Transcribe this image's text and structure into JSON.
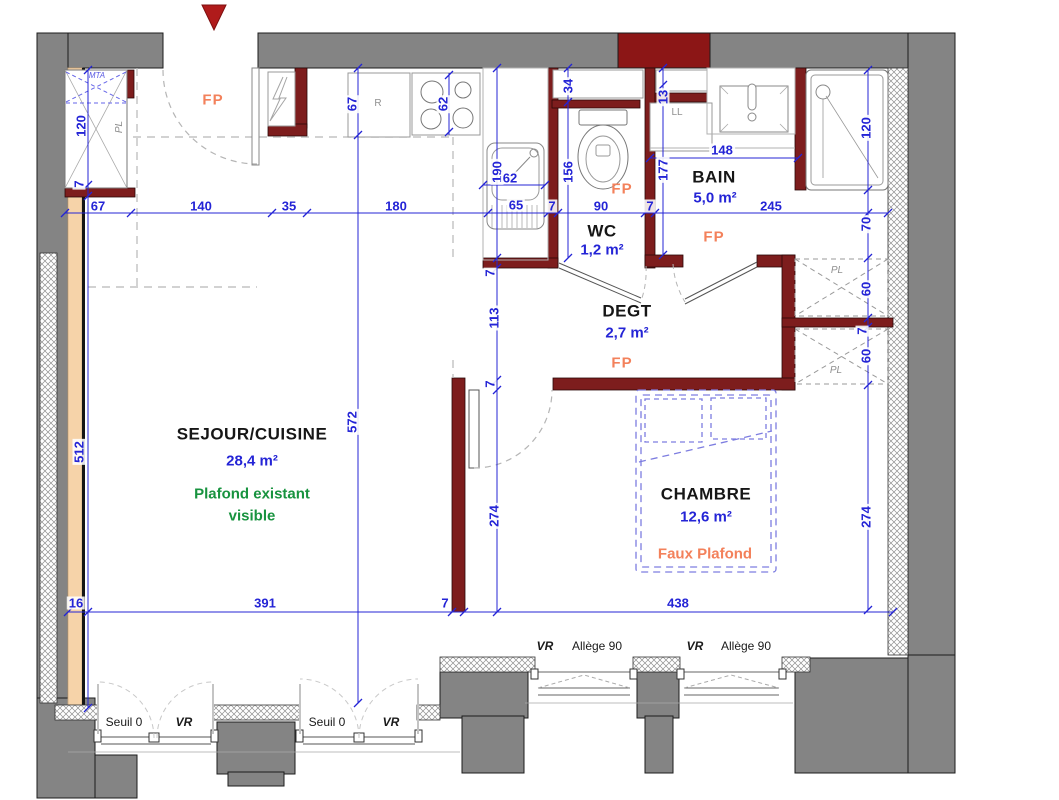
{
  "palette": {
    "existing_wall_gray": "#848484",
    "new_partition_maroon": "#7d1d1d",
    "top_accent_block": "#8c1616",
    "dimension_blue": "#2424d6",
    "fp_orange": "#f3815b",
    "note_green": "#18933f",
    "insulation_peach": "#f6d3a9",
    "entry_arrow_red": "#b01b1b",
    "furniture_dashed_blue": "#7d7de0"
  },
  "rooms": [
    {
      "name": "SEJOUR/CUISINE",
      "area": "28,4 m²",
      "note": "Plafond existant visible"
    },
    {
      "name": "WC",
      "area": "1,2 m²"
    },
    {
      "name": "DEGT",
      "area": "2,7 m²"
    },
    {
      "name": "BAIN",
      "area": "5,0 m²"
    },
    {
      "name": "CHAMBRE",
      "area": "12,6 m²",
      "note": "Faux Plafond"
    }
  ],
  "zone_labels": {
    "fp": "FP",
    "mta": "MTA",
    "pl": "PL",
    "ll": "LL",
    "fridge": "R"
  },
  "window_labels": {
    "seuil": "Seuil 0",
    "shutter": "VR",
    "sill": "Allège 90"
  },
  "dims": {
    "top_line": [
      "67",
      "140",
      "35",
      "180",
      "65",
      "7",
      "90",
      "7",
      "245"
    ],
    "bottom_line": [
      "16",
      "391",
      "7",
      "438"
    ],
    "left_line": [
      "120",
      "7",
      "512"
    ],
    "center_line": [
      "67",
      "572"
    ],
    "passage_line": [
      "190",
      "7",
      "113",
      "7",
      "274"
    ],
    "wc_line": [
      "34",
      "156"
    ],
    "bain_line": [
      "13",
      "177"
    ],
    "right_line": [
      "120",
      "70",
      "60",
      "7",
      "60",
      "274"
    ],
    "kitchen": {
      "hob_width": "62",
      "sink_width": "62"
    },
    "bain_sink_width": "148"
  }
}
